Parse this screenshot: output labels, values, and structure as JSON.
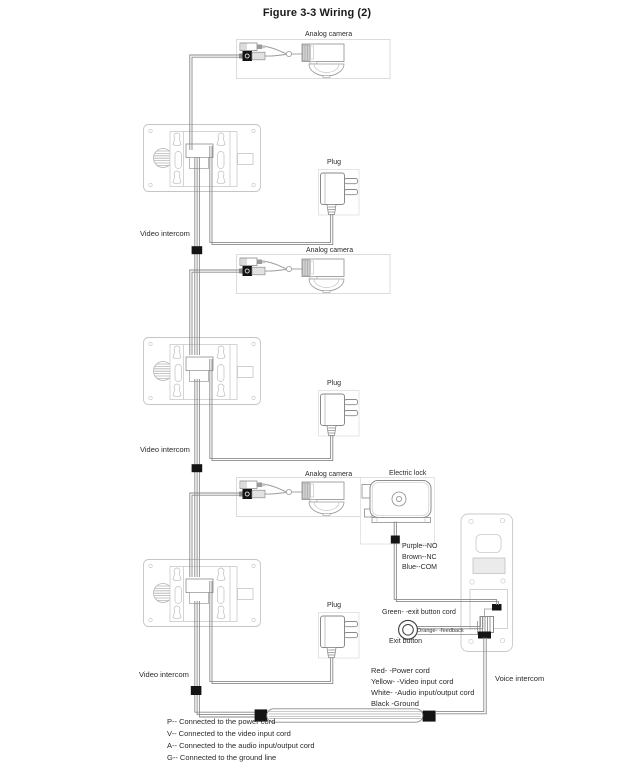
{
  "figure": {
    "title": "Figure 3-3 Wiring (2)"
  },
  "devices": {
    "analog_camera": "Analog camera",
    "video_intercom": "Video intercom",
    "plug": "Plug",
    "electric_lock": "Electric lock",
    "voice_intercom": "Voice intercom",
    "exit_button": "Exit button"
  },
  "wire_notes": {
    "lock": [
      "Purple--NO",
      "Brown--NC",
      "Blue--COM"
    ],
    "exit_button_cord": "Green- -exit button cord",
    "feedback": "Orange- -feedback",
    "intercom_cable": [
      "Red- -Power cord",
      "Yellow- -Video input cord",
      "White- -Audio input/output cord",
      "Black -Ground"
    ]
  },
  "legend": {
    "lines": [
      "P-- Connected to the power cord",
      "V-- Connected to the video input cord",
      "A-- Connected to the audio input/output cord",
      "G-- Connected to the ground line"
    ]
  }
}
